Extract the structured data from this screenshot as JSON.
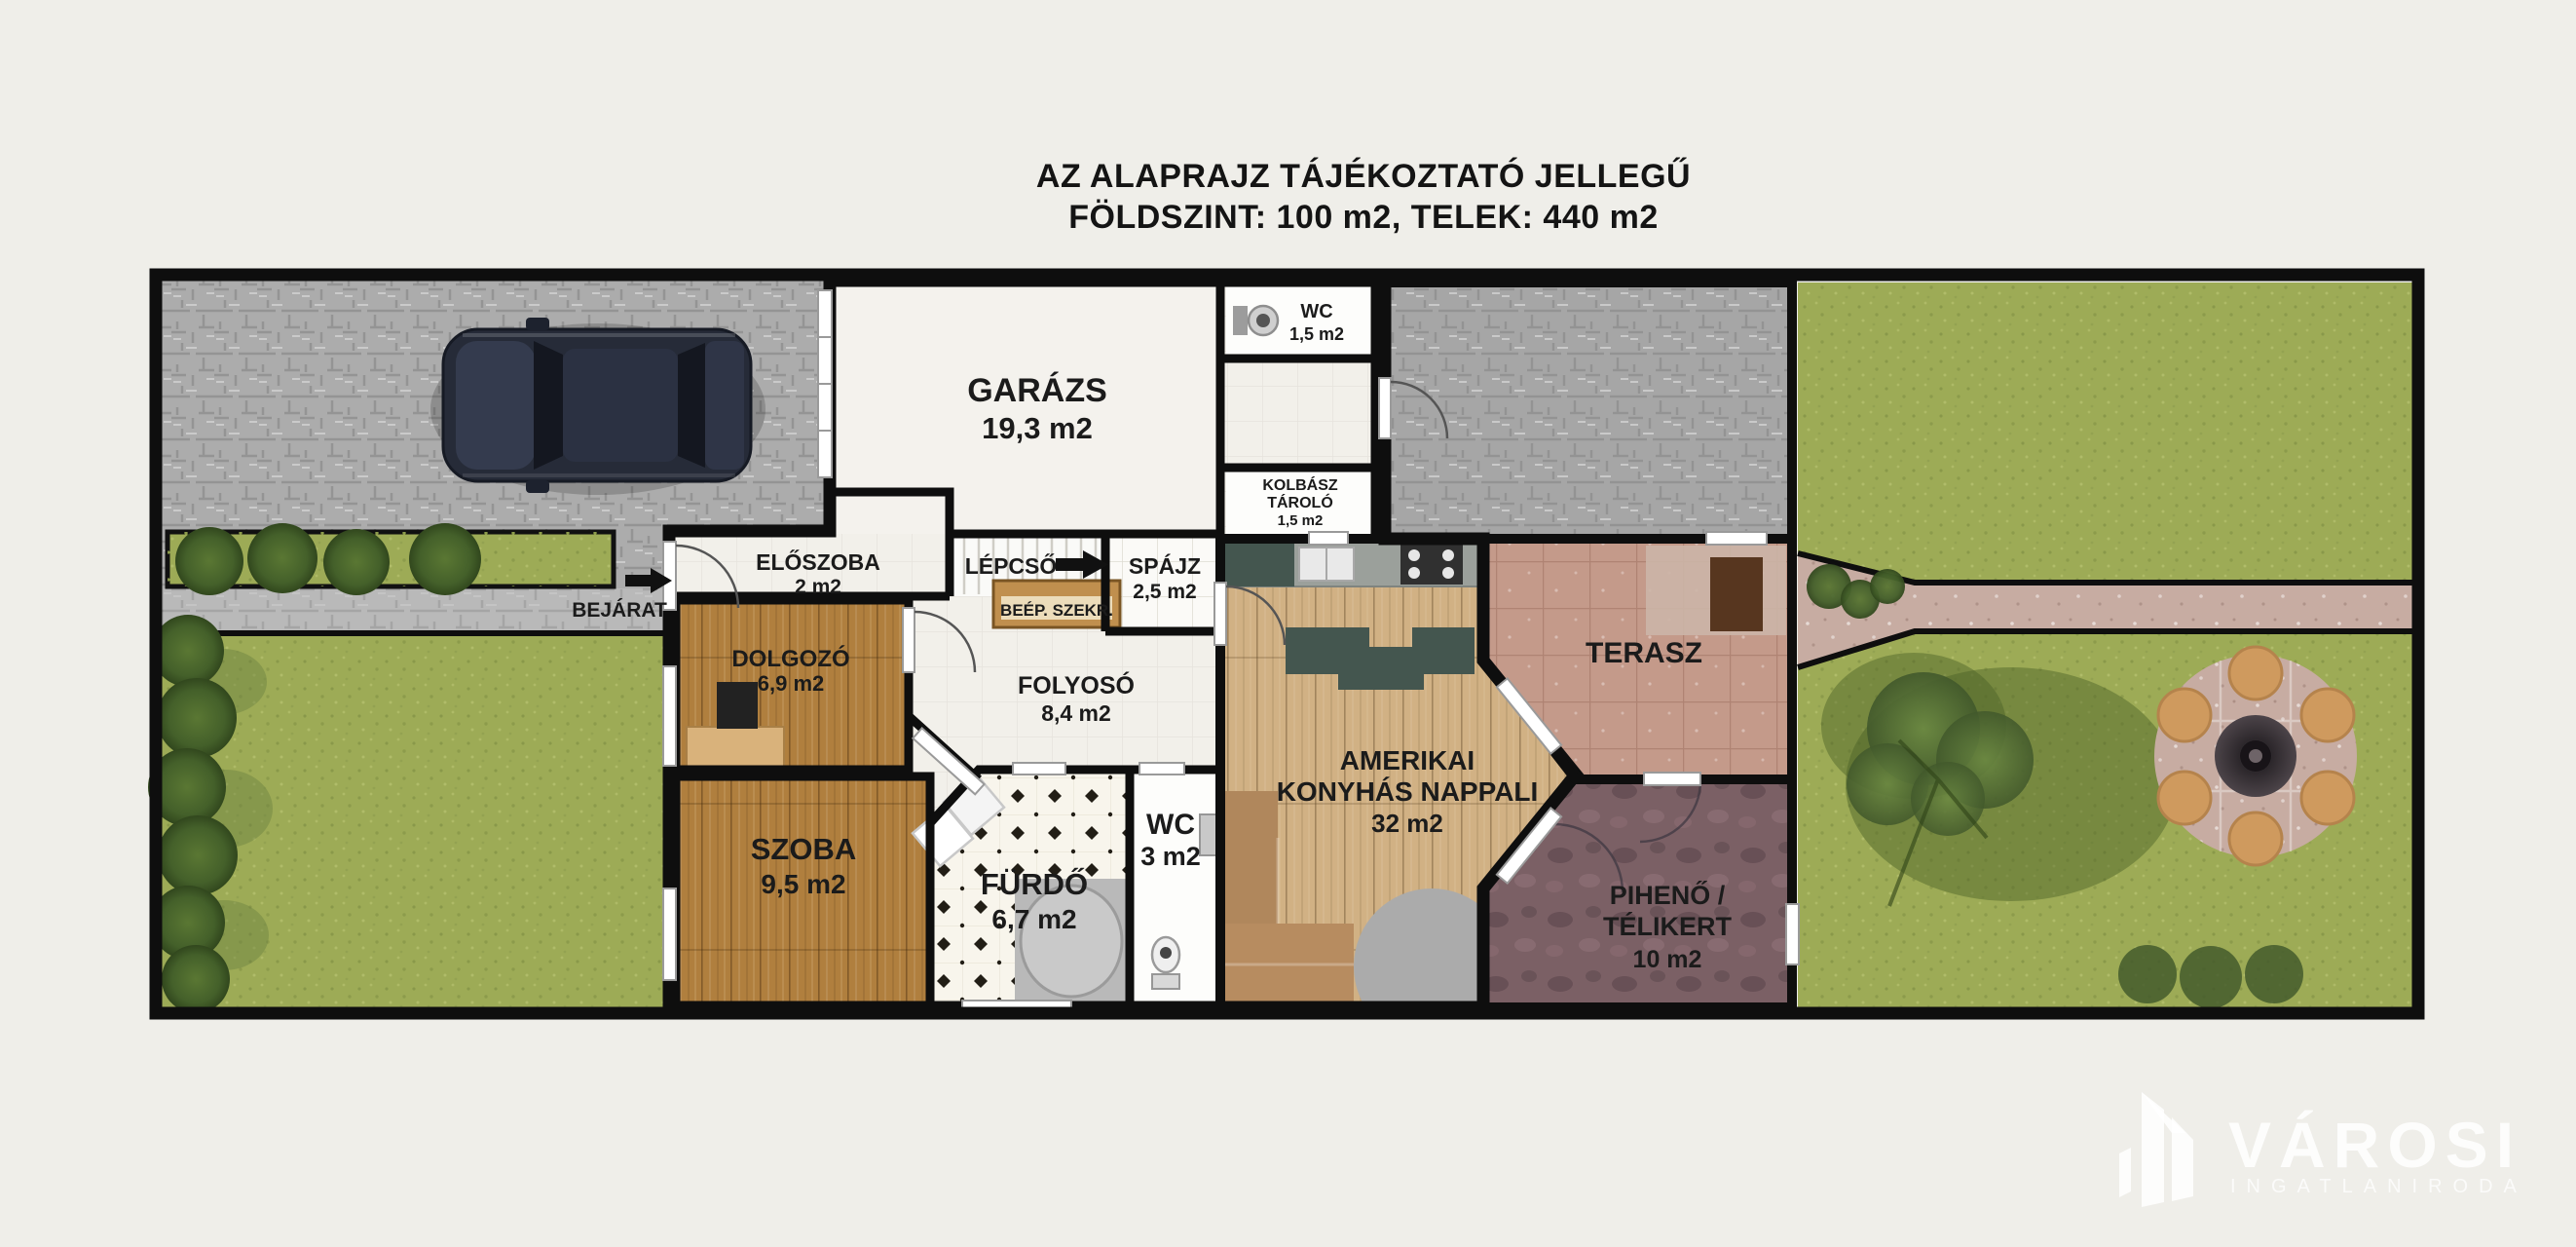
{
  "title": {
    "line1": "AZ ALAPRAJZ TÁJÉKOZTATÓ JELLEGŰ",
    "line2": "FÖLDSZINT: 100 m2, TELEK: 440 m2"
  },
  "rooms": {
    "garazs": {
      "name": "GARÁZS",
      "area": "19,3 m2"
    },
    "wc_felso": {
      "name": "WC",
      "area": "1,5 m2"
    },
    "kolbasz_tarolo": {
      "line1": "KOLBÁSZ",
      "line2": "TÁROLÓ",
      "area": "1,5 m2"
    },
    "eloszoba": {
      "name": "ELŐSZOBA",
      "area": "2 m2"
    },
    "lepcso": {
      "name": "LÉPCSŐ"
    },
    "spajz": {
      "name": "SPÁJZ",
      "area": "2,5 m2"
    },
    "beepitett_szekreny": {
      "name": "BEÉP. SZEKR."
    },
    "dolgozo": {
      "name": "DOLGOZÓ",
      "area": "6,9 m2"
    },
    "folyoso": {
      "name": "FOLYOSÓ",
      "area": "8,4 m2"
    },
    "szoba": {
      "name": "SZOBA",
      "area": "9,5 m2"
    },
    "furdo": {
      "name": "FÜRDŐ",
      "area": "6,7 m2"
    },
    "wc_also": {
      "name": "WC",
      "area": "3 m2"
    },
    "nappali": {
      "line1": "AMERIKAI",
      "line2": "KONYHÁS NAPPALI",
      "area": "32 m2"
    },
    "terasz": {
      "name": "TERASZ"
    },
    "piheno": {
      "line1": "PIHENŐ /",
      "line2": "TÉLIKERT",
      "area": "10 m2"
    }
  },
  "outdoor": {
    "bejarat_label": "BEJÁRAT"
  },
  "watermark": {
    "brand": "VÁROSI",
    "tagline": "INGATLANIRODA"
  },
  "colors": {
    "page": "#efeee9",
    "wall": "#0e0e0e",
    "pavement": "#acacac",
    "walkway": "#b9b9b9",
    "grass": "#9dab56",
    "hedge": "#44602a",
    "wood": "#b07f3e",
    "wood_light": "#d1b184",
    "floor_white": "#f2f0ea",
    "bath_tile": "#f8f5ec",
    "terrace": "#c49a8a",
    "terrace_light": "#ccb5a7",
    "stone_dark": "#7b6065",
    "path_stone": "#c7aca2",
    "counter": "#9ba09b",
    "cabinet_teal": "#44564f",
    "sofa_brown": "#b0875c",
    "wardrobe": "#c08f4e",
    "car": "#262b38",
    "patio_seat": "#cf9a5e"
  }
}
